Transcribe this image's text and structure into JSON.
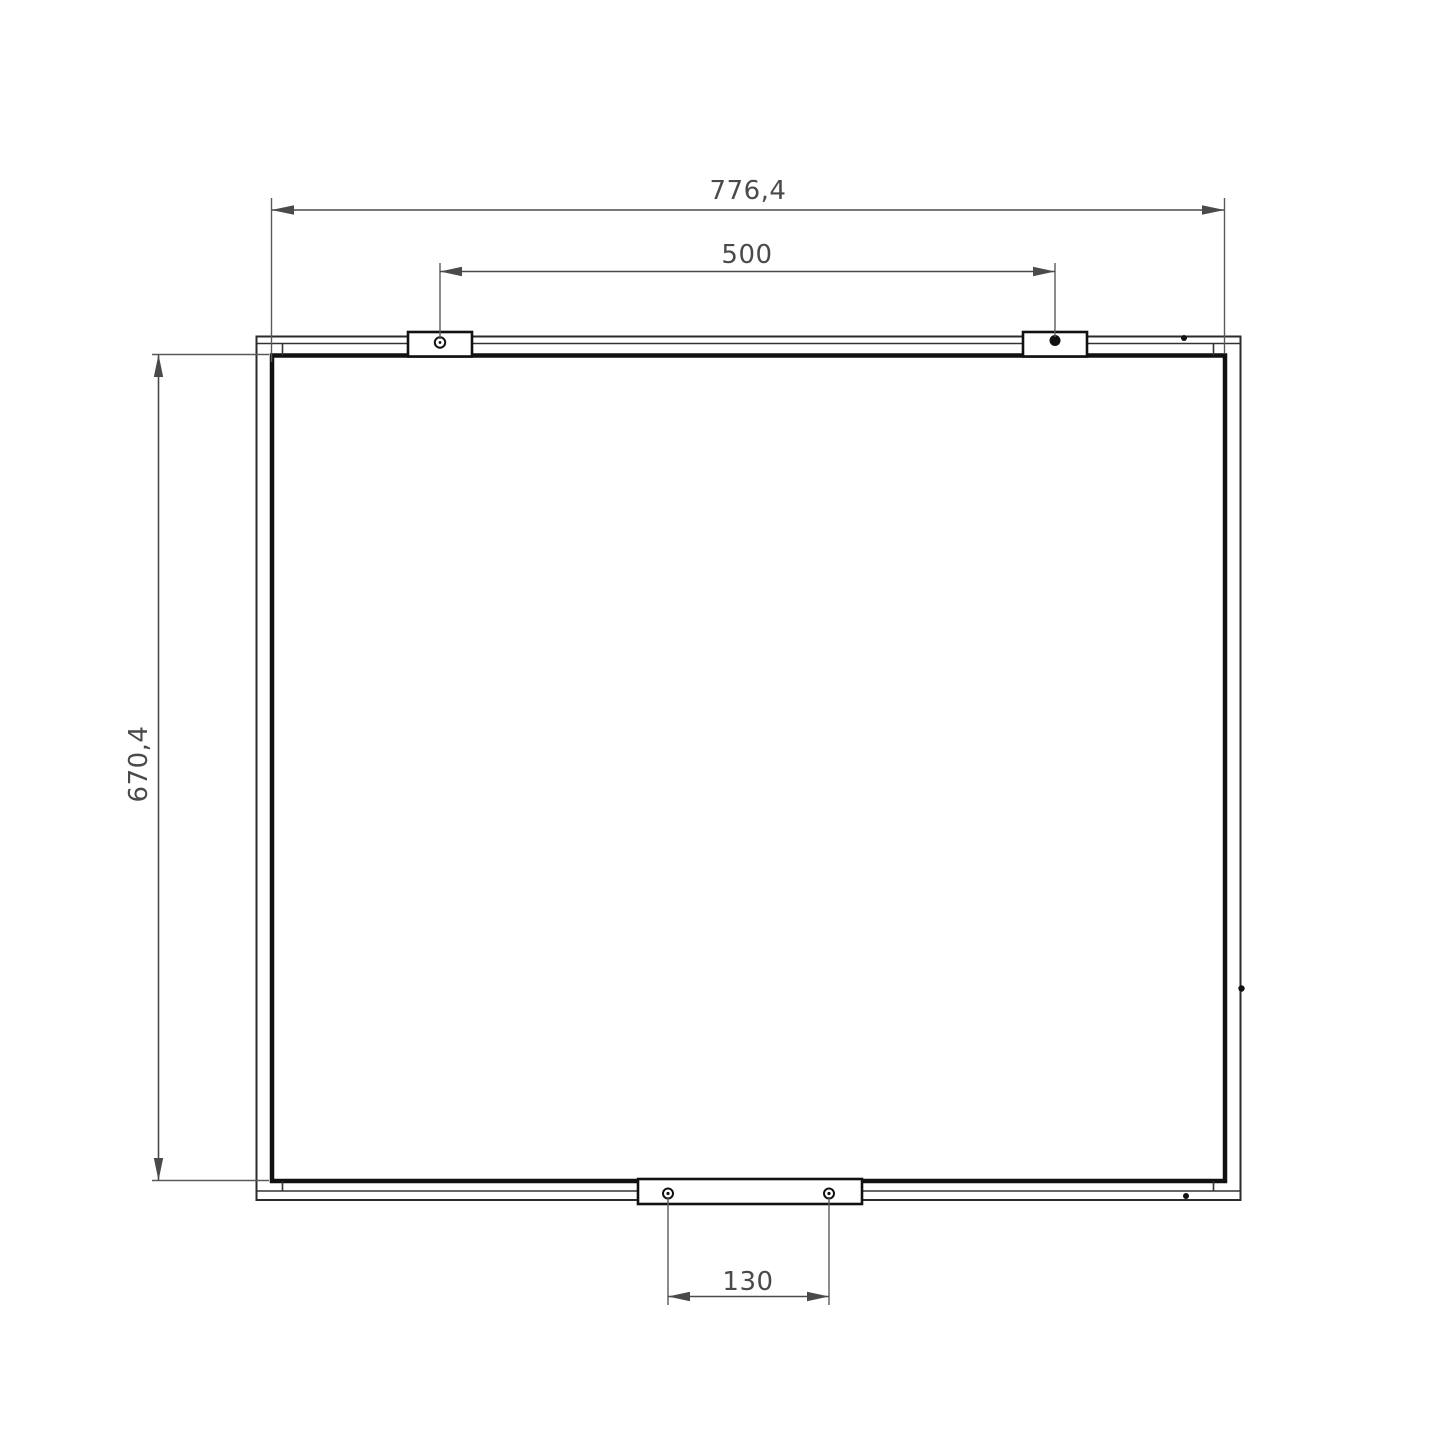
{
  "drawing": {
    "background": "#ffffff",
    "outline_color": "#111111",
    "dim_color": "#4a4a4a",
    "dims": {
      "overall_width": "776,4",
      "top_hole_spacing": "500",
      "overall_height": "670,4",
      "bottom_hole_spacing": "130"
    }
  }
}
